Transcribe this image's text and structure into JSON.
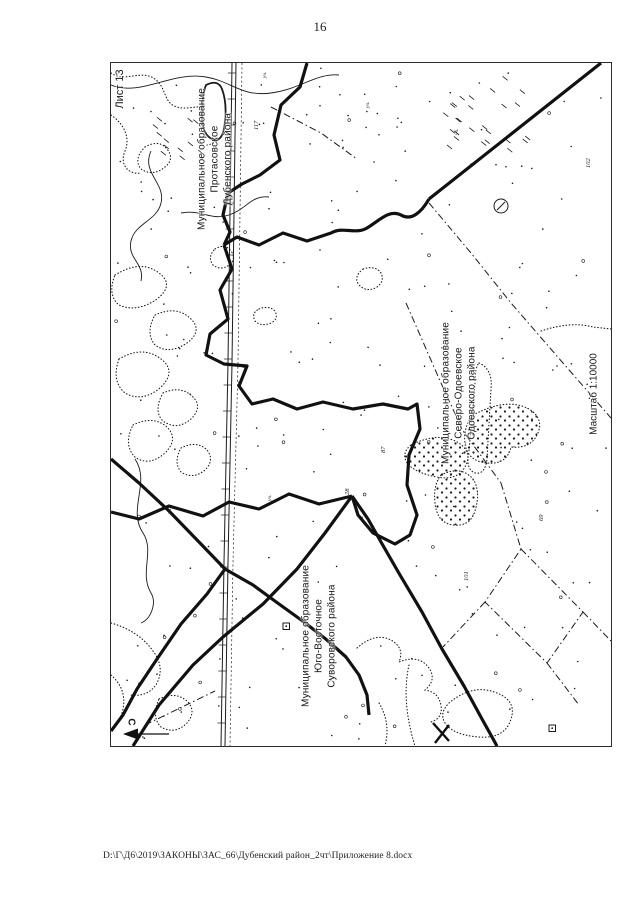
{
  "page": {
    "number": "16",
    "footer_path": "D:\\Г\\Д6\\2019\\ЗАКОНЫ\\ЗАС_66\\Дубенский район_2чт\\Приложение 8.docx"
  },
  "map": {
    "sheet_label": "Лист 13",
    "scale_label": "Масштаб 1:10000",
    "compass_letter": "С",
    "ink_color": "#1b1b1b",
    "labels": {
      "protasovskoe": {
        "line1": "Муниципальное образование",
        "line2": "Протасовское",
        "line3": "Дубенского района"
      },
      "severo_odoevskoe": {
        "line1": "Муниципальное образование",
        "line2": "Северо-Одоевское",
        "line3": "Одоевского района"
      },
      "yugo_vostochnoe": {
        "line1": "Муниципальное образование",
        "line2": "Юго-Восточное",
        "line3": "Суворовского района"
      }
    },
    "plot_label_prefix": "уч.",
    "plot_numbers": [
      "28",
      "87",
      "102",
      "117",
      "101",
      "69"
    ]
  }
}
